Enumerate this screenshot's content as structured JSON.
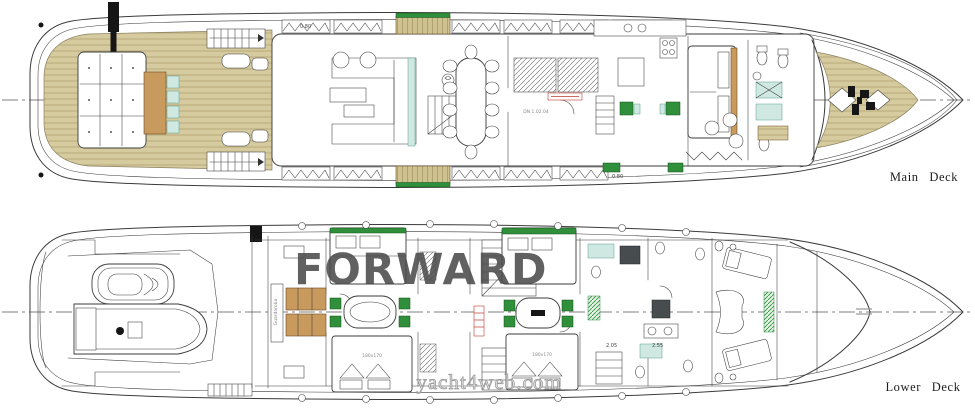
{
  "decks": {
    "main": {
      "label": "Main Deck"
    },
    "lower": {
      "label": "Lower Deck"
    }
  },
  "watermarks": {
    "forward": "FORWARD",
    "site": "yacht4web.com"
  },
  "annotations": {
    "height_1": "0.80",
    "height_2": "0.80",
    "height_3": "2.05",
    "height_4": "2.55",
    "storage": "DN 1.02.04",
    "wardrobe": "Guardaroba",
    "bed_size_1": "180x170",
    "bed_size_2": "180x170"
  },
  "colors": {
    "line": "#3b3b3b",
    "deck_wood": "#d6cb9f",
    "deck_wood_line": "#ab9d6e",
    "furniture_wood": "#c89a5e",
    "teal": "#cfe9e2",
    "green": "#2f8f3a",
    "watermark_gray": "#4c4c4c",
    "site_gray": "#8f8f8f",
    "red_accent": "#c0392b"
  }
}
